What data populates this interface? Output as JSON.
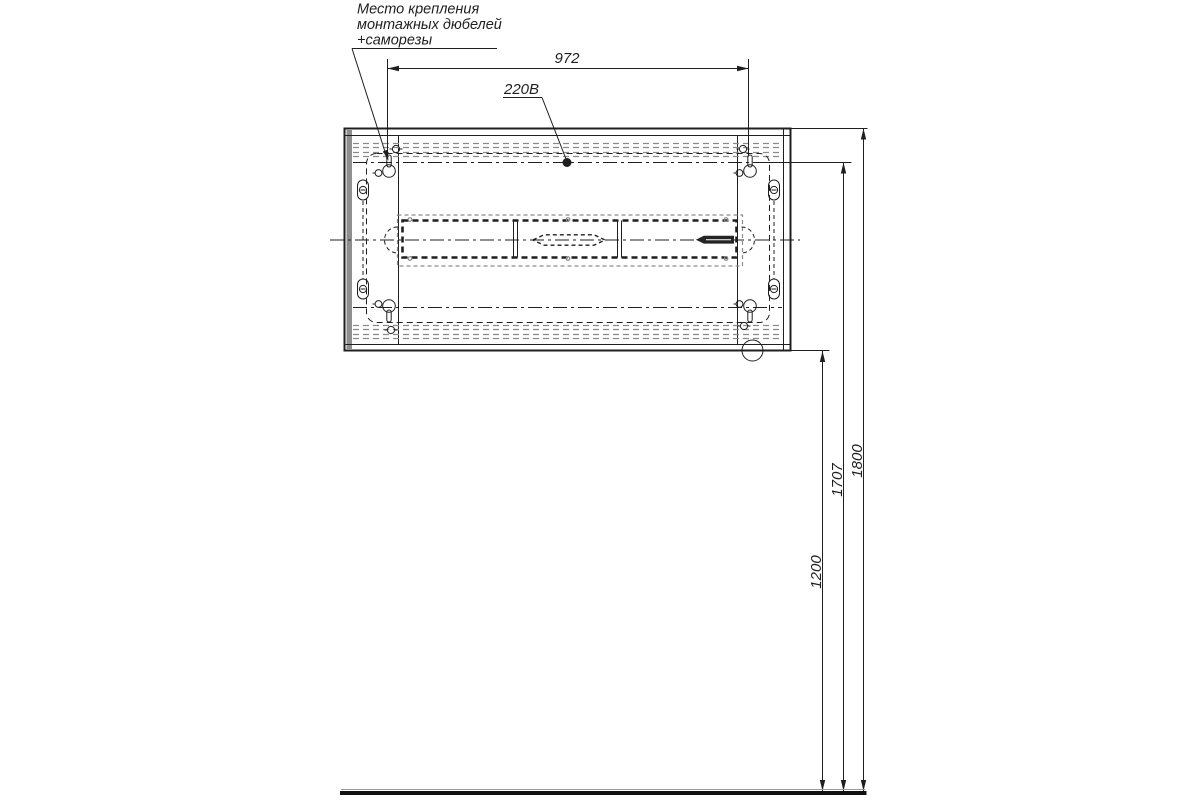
{
  "callouts": {
    "mount_line1": "Место крепления",
    "mount_line2": "монтажных дюбелей",
    "mount_line3": "+саморезы",
    "power": "220В"
  },
  "dimensions": {
    "width_top": "972",
    "height_bottom": "1200",
    "height_mount": "1707",
    "height_overall": "1800"
  },
  "colors": {
    "ink": "#1f1f1f",
    "gray_dash": "#8a8a8a",
    "edge_shade": "#8f8f8f",
    "background": "#ffffff"
  }
}
